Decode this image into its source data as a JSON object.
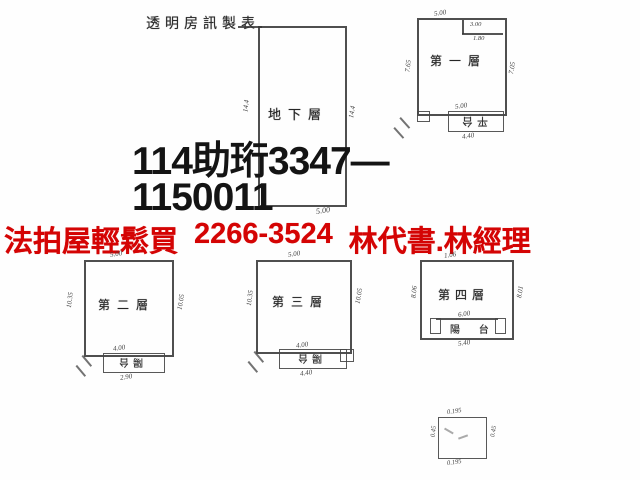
{
  "title": "透明房訊製表",
  "stamp": {
    "line1": "114助珩3347—",
    "line2": "1150011"
  },
  "banner": {
    "slogan": "法拍屋輕鬆買",
    "phone": "2266-3524",
    "contact": "林代書.林經理",
    "color": "#d40404"
  },
  "plans": {
    "basement": {
      "label": "地下層",
      "dim_left": "14.4",
      "dim_right": "14.4",
      "dim_bottom": "5.00"
    },
    "floor1": {
      "label": "第一層",
      "annex_label": "平台",
      "dim_top": "5.00",
      "notch_dim_a": "3.00",
      "notch_dim_b": "1.80",
      "dim_left": "7.65",
      "dim_right": "7.05",
      "dim_annex_top": "5.00",
      "dim_annex_bottom": "4.40"
    },
    "floor2": {
      "label": "第二層",
      "annex_label": "陽台",
      "dim_top": "5.00",
      "dim_left": "10.35",
      "dim_right": "10.05",
      "dim_annex_top": "4.00",
      "dim_annex_bottom": "2.90"
    },
    "floor3": {
      "label": "第三層",
      "annex_label": "陽台",
      "dim_top": "5.00",
      "dim_left": "10.35",
      "dim_right": "10.05",
      "dim_annex_top": "4.00",
      "dim_annex_bottom": "4.40"
    },
    "floor4": {
      "label": "第四層",
      "annex_label": "陽 台",
      "dim_top": "1.06",
      "dim_left": "8.06",
      "dim_right": "8.01",
      "dim_annex_top": "6.00",
      "dim_annex_bottom": "5.40"
    },
    "tank": {
      "dim_top": "0.195",
      "dim_bottom": "0.195",
      "dim_left": "0.45",
      "dim_right": "0.45"
    }
  }
}
